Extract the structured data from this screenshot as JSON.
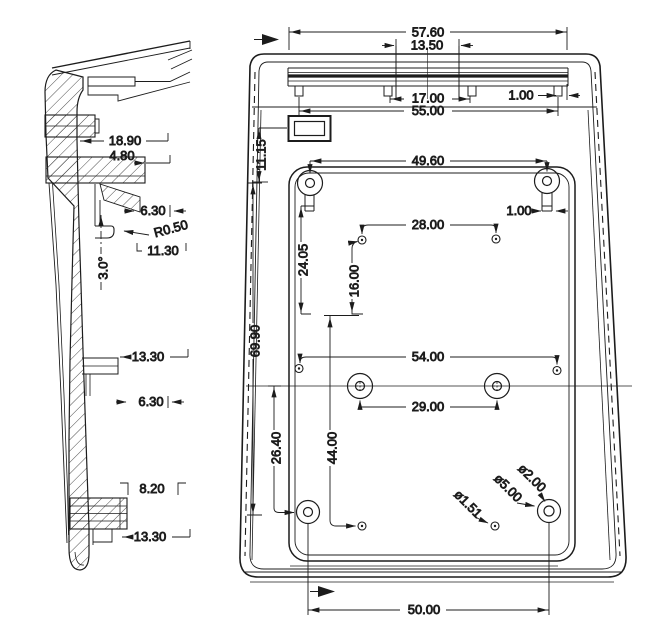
{
  "dims": {
    "left": {
      "d18_90": "18.90",
      "d4_80": "4.80",
      "d6_30_top": "6.30",
      "r0_50": "R0.50",
      "d11_30": "11.30",
      "draft_angle": "3.0°",
      "d13_30_mid": "13.30",
      "d6_30_mid": "6.30",
      "d8_20": "8.20",
      "d13_30_bot": "13.30"
    },
    "right": {
      "d57_60": "57.60",
      "d13_50": "13.50",
      "d17_00": "17.00",
      "d55_00": "55.00",
      "d1_00_top": "1.00",
      "d11_15": "11.15",
      "d49_60": "49.60",
      "d1_00_side": "1.00",
      "d28_00": "28.00",
      "d24_05": "24.05",
      "d16_00": "16.00",
      "d69_90": "69.90",
      "d54_00": "54.00",
      "d29_00": "29.00",
      "d44_00": "44.00",
      "d26_40": "26.40",
      "dia2_00": "ø2.00",
      "dia5_00": "ø5.00",
      "dia1_51": "ø1.51",
      "d50_00": "50.00"
    }
  },
  "colors": {
    "line": "#1c1c1c",
    "background": "#ffffff"
  }
}
